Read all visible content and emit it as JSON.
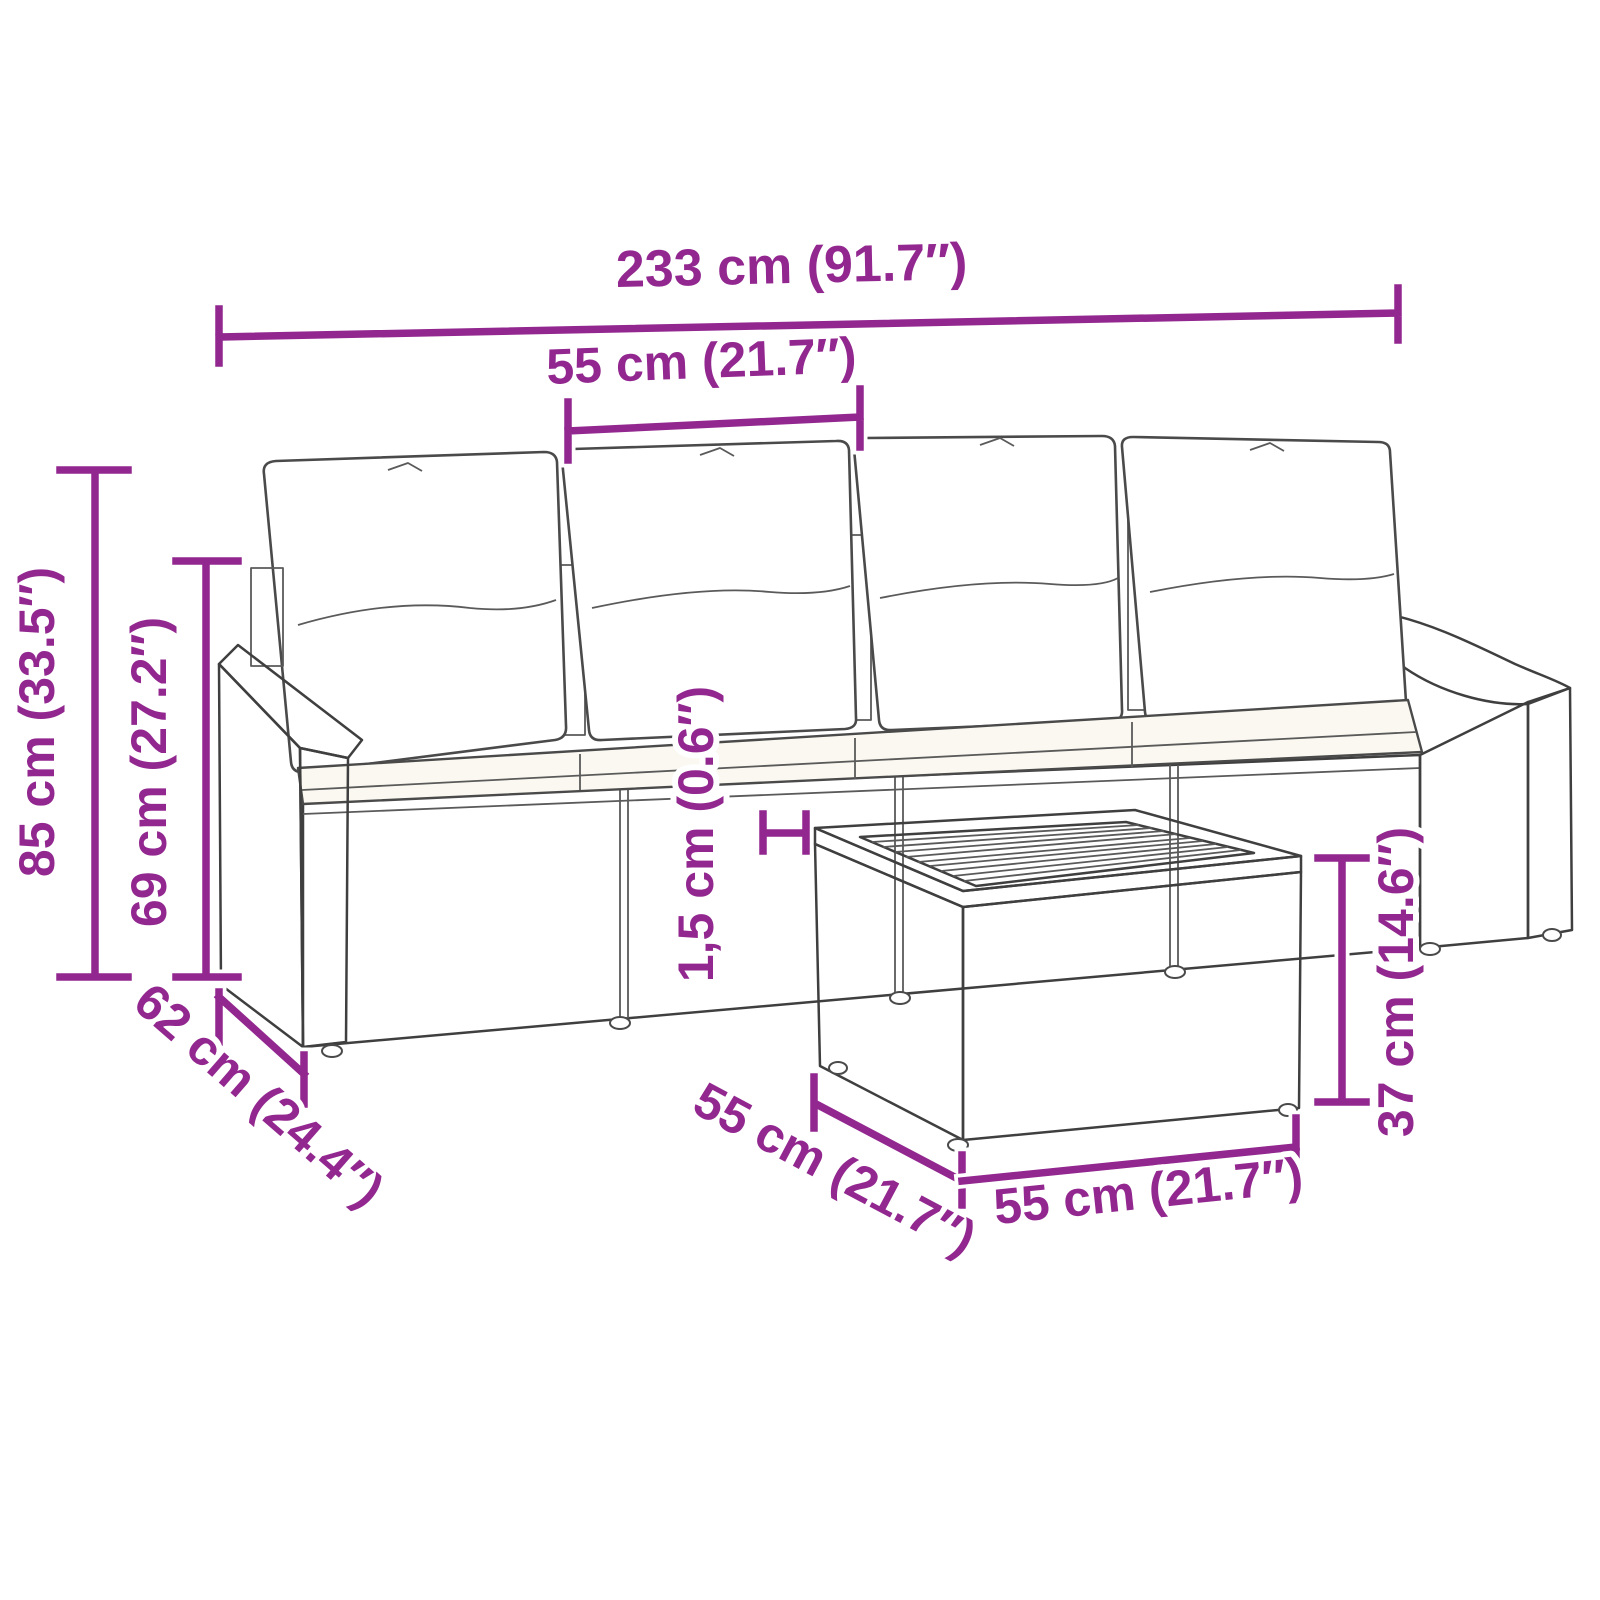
{
  "diagram": {
    "title": "Garden sofa set dimension diagram",
    "accent_color": "#92278f",
    "line_art_color": "#3f3f3f",
    "dimensions": {
      "overall_width": "233 cm (91.7″)",
      "seat_width": "55 cm (21.7″)",
      "total_height": "85 cm (33.5″)",
      "seat_back_height": "69 cm (27.2″)",
      "depth": "62 cm (24.4″)",
      "cushion_thickness": "1,5 cm (0.6″)",
      "table_depth": "55 cm (21.7″)",
      "table_width": "55 cm (21.7″)",
      "table_height": "37 cm (14.6″)"
    }
  }
}
